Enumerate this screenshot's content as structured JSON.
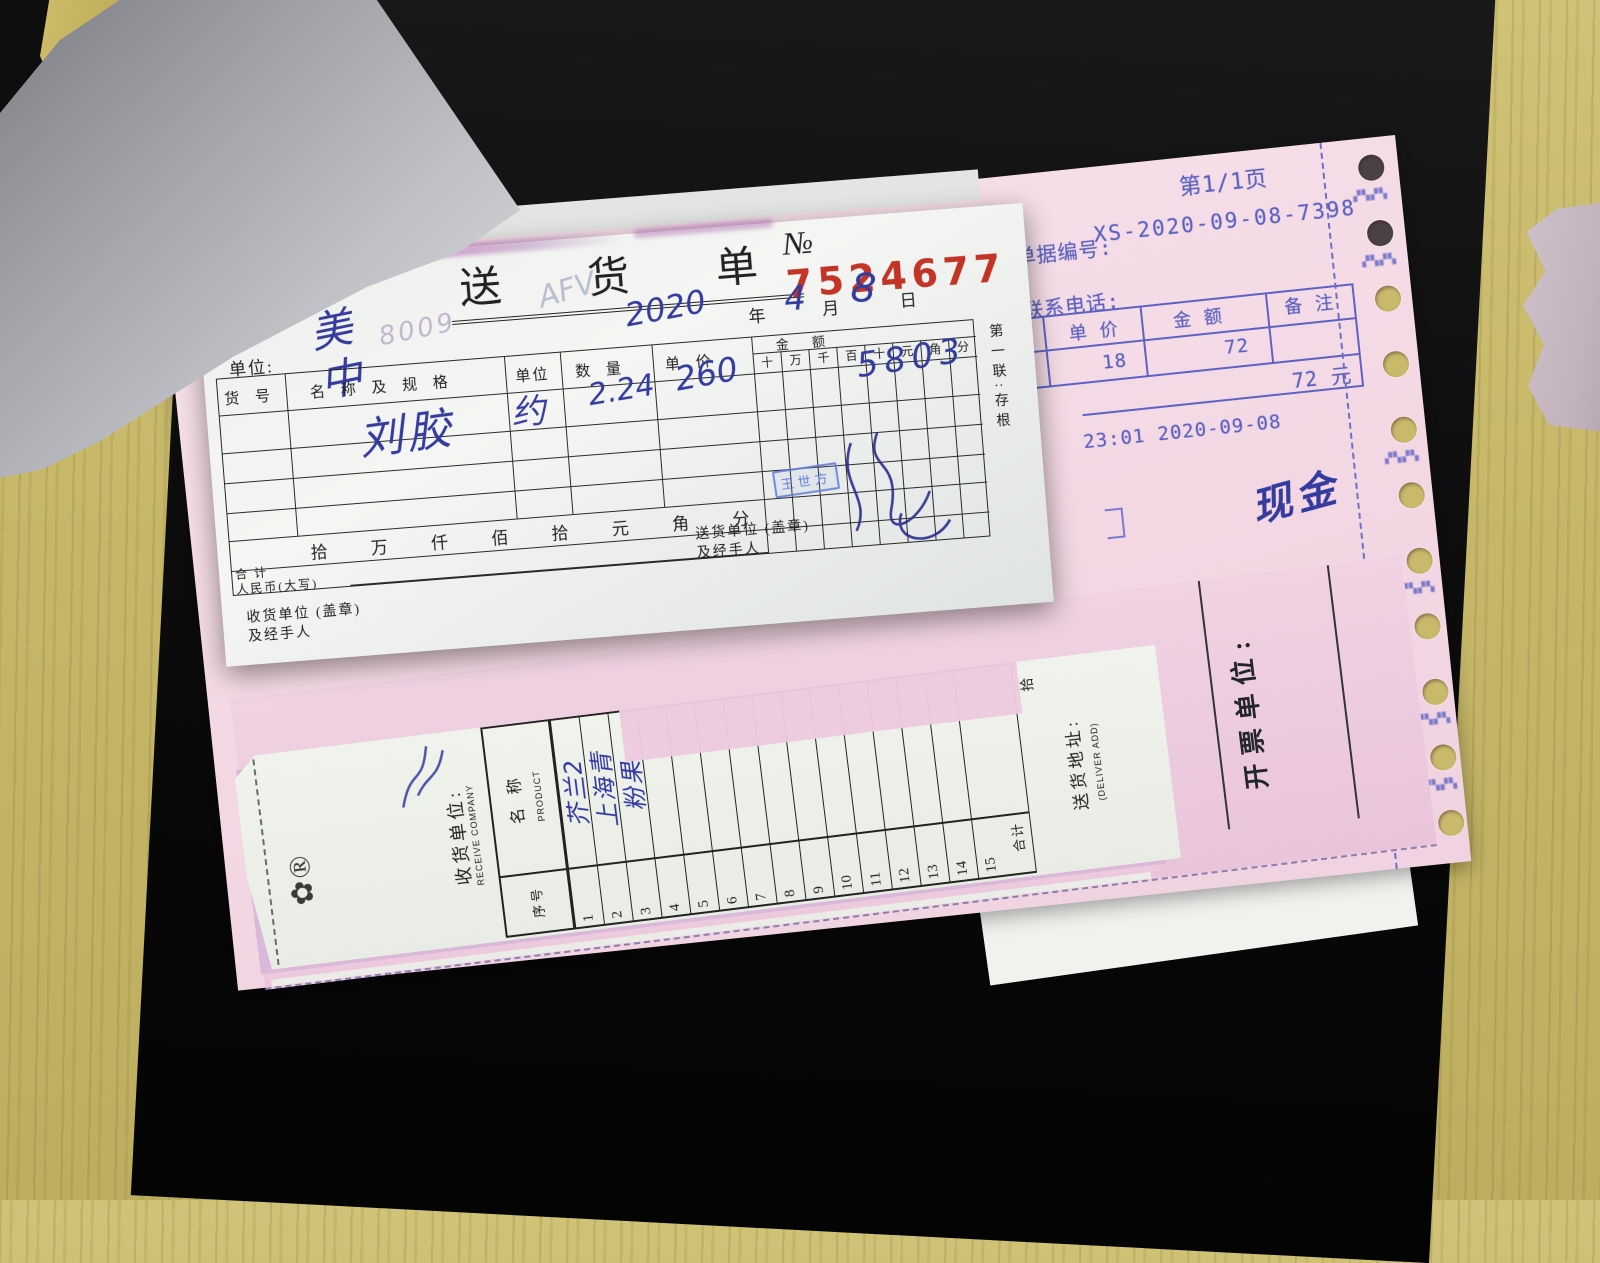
{
  "colors": {
    "wood": "#c3b466",
    "surface_black": "#0f0f10",
    "pink_sheet": "#f3d8e4",
    "pink_copy": "#eccade",
    "receipt_paper": "#f2f3f0",
    "print_blue": "#5a60c0",
    "ink_blue": "#333b9e",
    "red_number": "#c23425"
  },
  "delivery_note": {
    "title": "送  货  单",
    "no_symbol": "№",
    "no_value": "7524677",
    "date": {
      "year_hw": "2020",
      "year_label": "年",
      "month_hw": "4",
      "month_label": "月",
      "day_hw": "8",
      "day_label": "日"
    },
    "unit_label": "单位:",
    "unit_hw": "美中",
    "bleed_hw": "8009",
    "bleed_hw2": "AFV",
    "col_item": "货    号",
    "col_name": "名 称 及 规 格",
    "col_unit": "单位",
    "col_qty": "数   量",
    "col_price": "单   价",
    "amount_label": "金        额",
    "amount_digits": [
      "十",
      "万",
      "千",
      "百",
      "十",
      "元",
      "角",
      "分"
    ],
    "row": {
      "name": "刘胶",
      "unit": "约",
      "qty": "2.24",
      "price": "260",
      "amount": "5803"
    },
    "stamp": "王世方",
    "caps_row": [
      "拾",
      "万",
      "仟",
      "佰",
      "拾",
      "元",
      "角",
      "分"
    ],
    "total_line1": "合  计",
    "total_line2": "人民币(大写)",
    "sender_line1": "送货单位 (盖章)",
    "sender_line2": "及经手人",
    "receiver_line1": "收货单位 (盖章)",
    "receiver_line2": "及经手人",
    "copy_label": "第一联:存根"
  },
  "pink_form": {
    "page": "第1/1页",
    "doc_label": "单据编号:",
    "doc_no": "XS-2020-09-08-7398",
    "tel_label": "联系电话:",
    "col_price": "单  价",
    "col_amount": "金  额",
    "col_note": "备 注",
    "price": "18",
    "amount": "72",
    "total": "72 元",
    "timestamp": "23:01 2020-09-08",
    "cash_hw": "现金",
    "issuer_label": "开票单位:",
    "margin_marks": [
      "▞▚▞▚",
      "▞▚▞▚",
      "▞▚▞▚",
      "▞▚▞▚",
      "▞▚▞▚",
      "▞▚▞▚"
    ]
  },
  "receive_form": {
    "logo_glyph": "✿®",
    "receive_label": "收货单位:",
    "receive_en": "RECEIVE COMPANY",
    "name_label": "名  称",
    "name_en": "PRODUCT",
    "seq_label": "序号",
    "numbers": [
      "1",
      "2",
      "3",
      "4",
      "5",
      "6",
      "7",
      "8",
      "9",
      "10",
      "11",
      "12",
      "13",
      "14",
      "15"
    ],
    "total_label": "合计",
    "caps_char": "拾",
    "addr_label": "送货地址:",
    "addr_en": "(DELIVER ADD)",
    "products_hw": [
      "芥兰2",
      "上海青",
      "粉果"
    ]
  }
}
